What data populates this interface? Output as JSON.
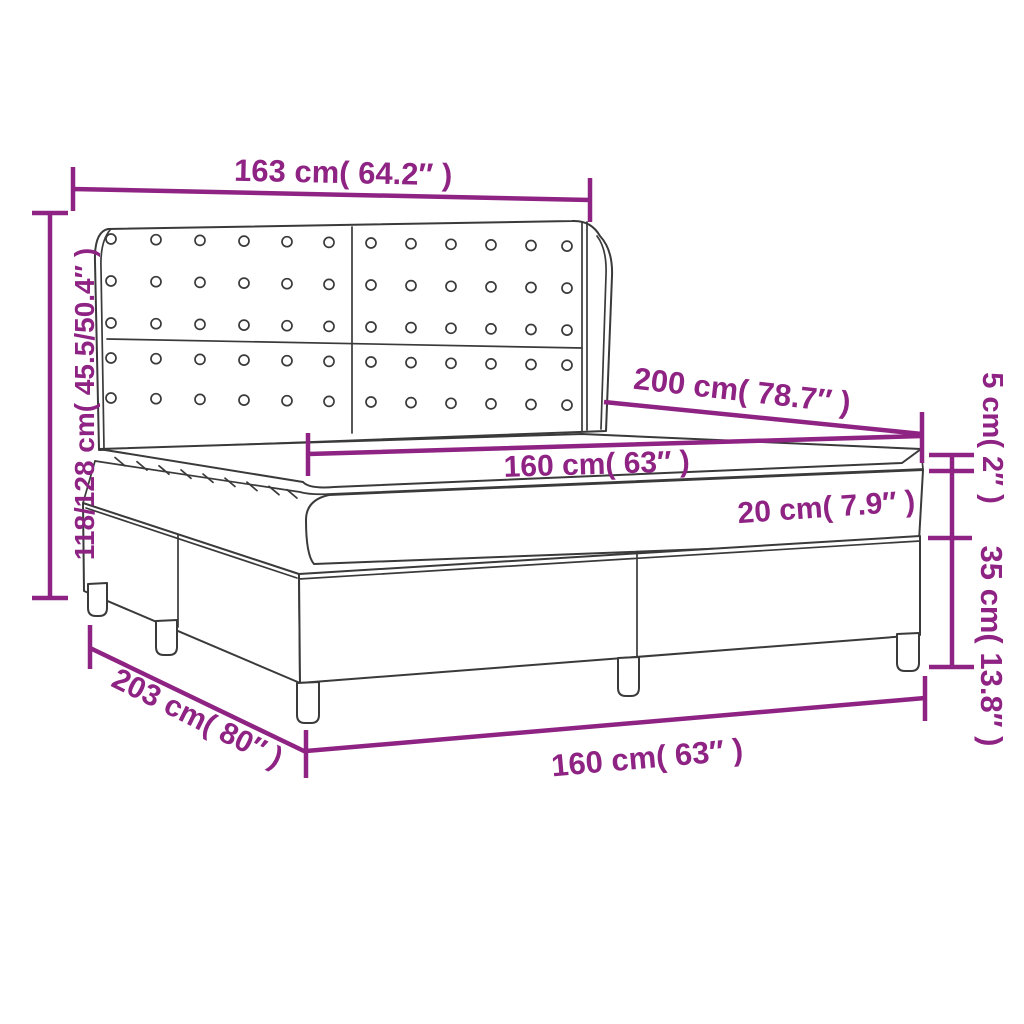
{
  "diagram": {
    "accent_color": "#8e2383",
    "outline_color": "#3a3a3a",
    "labels": {
      "headboard_width": "163 cm( 64.2″ )",
      "total_height": "118/128 cm( 45.5/50.4″ )",
      "bed_length": "200 cm( 78.7″ )",
      "mattress_width": "160 cm( 63″ )",
      "mattress_thickness": "20 cm( 7.9″ )",
      "topper_thickness": "5 cm( 2″ )",
      "base_height": "35 cm( 13.8″ )",
      "total_length": "203 cm( 80″ )",
      "base_width": "160 cm( 63″ )"
    }
  }
}
